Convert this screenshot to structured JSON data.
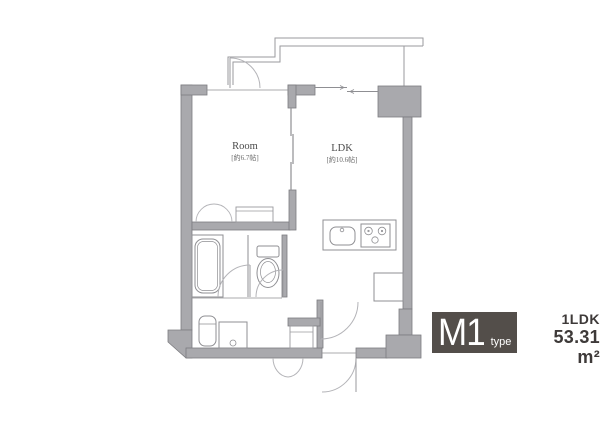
{
  "plan": {
    "rooms": [
      {
        "name": "Room",
        "size": "[約6.7帖]"
      },
      {
        "name": "LDK",
        "size": "[約10.6帖]"
      }
    ],
    "fixtures": [
      "bathtub",
      "toilet",
      "washbasin",
      "washing-machine",
      "kitchen-sink",
      "stove",
      "refrigerator",
      "closet",
      "storage",
      "shoe-closet"
    ]
  },
  "badge": {
    "code": "M1",
    "code_suffix": "type",
    "layout": "1LDK",
    "area": "53.31 m²"
  },
  "colors": {
    "wall_fill": "#a9a9ad",
    "wall_stroke": "#7c7c80",
    "thin_line": "#8f8f93",
    "door_arc": "#b4b4b8",
    "badge_bg": "#534e4a",
    "badge_text": "#ffffff",
    "info_text": "#3e3a39",
    "label_text": "#4a4a4a",
    "background": "#ffffff"
  }
}
